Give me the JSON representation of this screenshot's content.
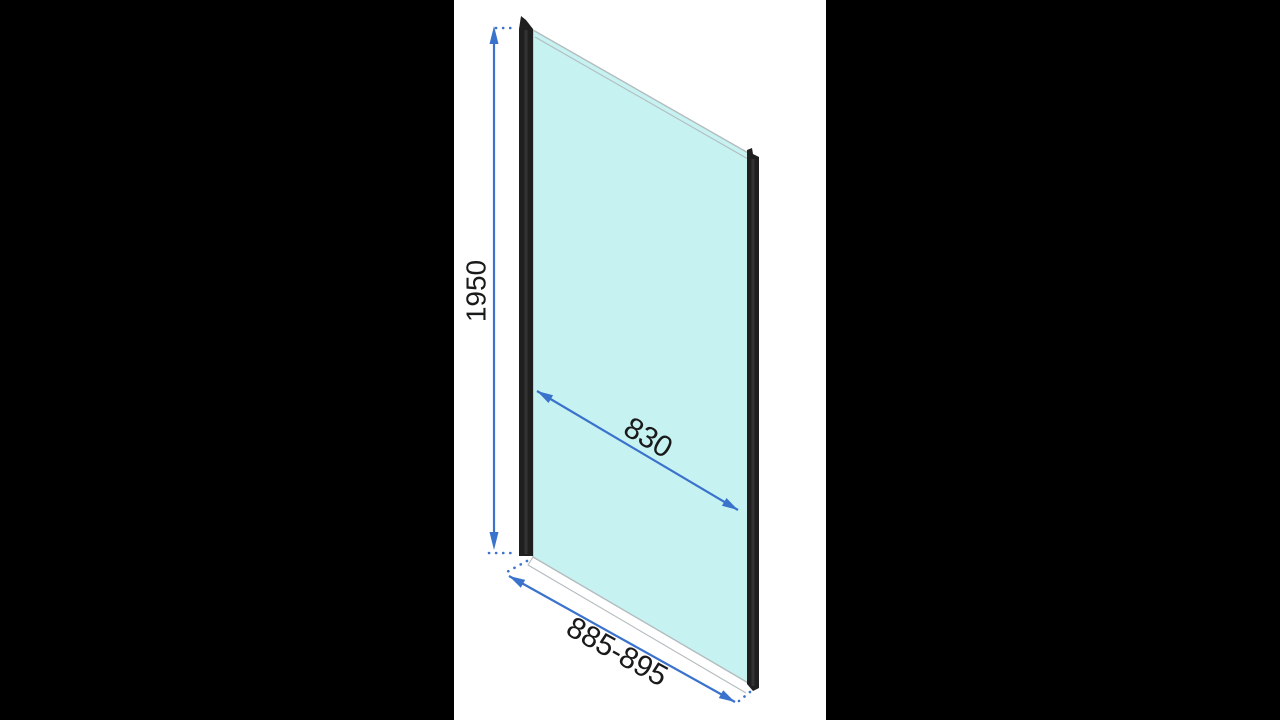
{
  "colors": {
    "accent": "#3a72cc",
    "glass": "#c6f2f2",
    "glass_edge": "#b4bcbe",
    "profile": "#1f1f1f",
    "label": "#1a1a1a",
    "side_bar": "#000000",
    "canvas_white": "#ffffff"
  },
  "diagram": {
    "dimensions": {
      "height": {
        "label": "1950"
      },
      "glass_width": {
        "label": "830"
      },
      "overall_width": {
        "label": "885-895"
      }
    }
  }
}
